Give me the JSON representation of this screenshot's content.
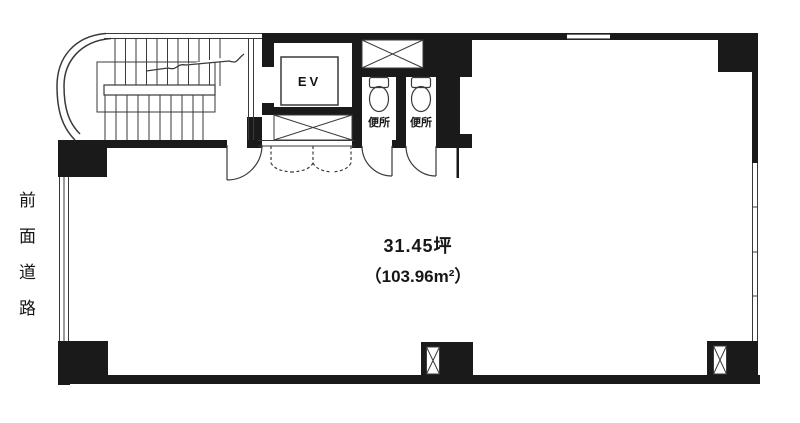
{
  "colors": {
    "wall": "#1a1a1a",
    "line": "#3a3a3a",
    "bg": "#ffffff"
  },
  "floor_plan": {
    "type": "office-building-floor-plan",
    "annotations": {
      "front_road": "前面道路"
    },
    "rooms": {
      "main_area": {
        "area_tsubo": "31.45坪",
        "area_sqm": "（103.96m²）"
      },
      "elevator": {
        "label": "EV"
      },
      "toilets": [
        {
          "label": "便所"
        },
        {
          "label": "便所"
        }
      ]
    },
    "icons": {
      "pipe_shaft": "x-cross-box",
      "duct": "x-cross-box",
      "toilet": "toilet-bowl-outline",
      "stairs": "tread-lines-with-break"
    }
  }
}
